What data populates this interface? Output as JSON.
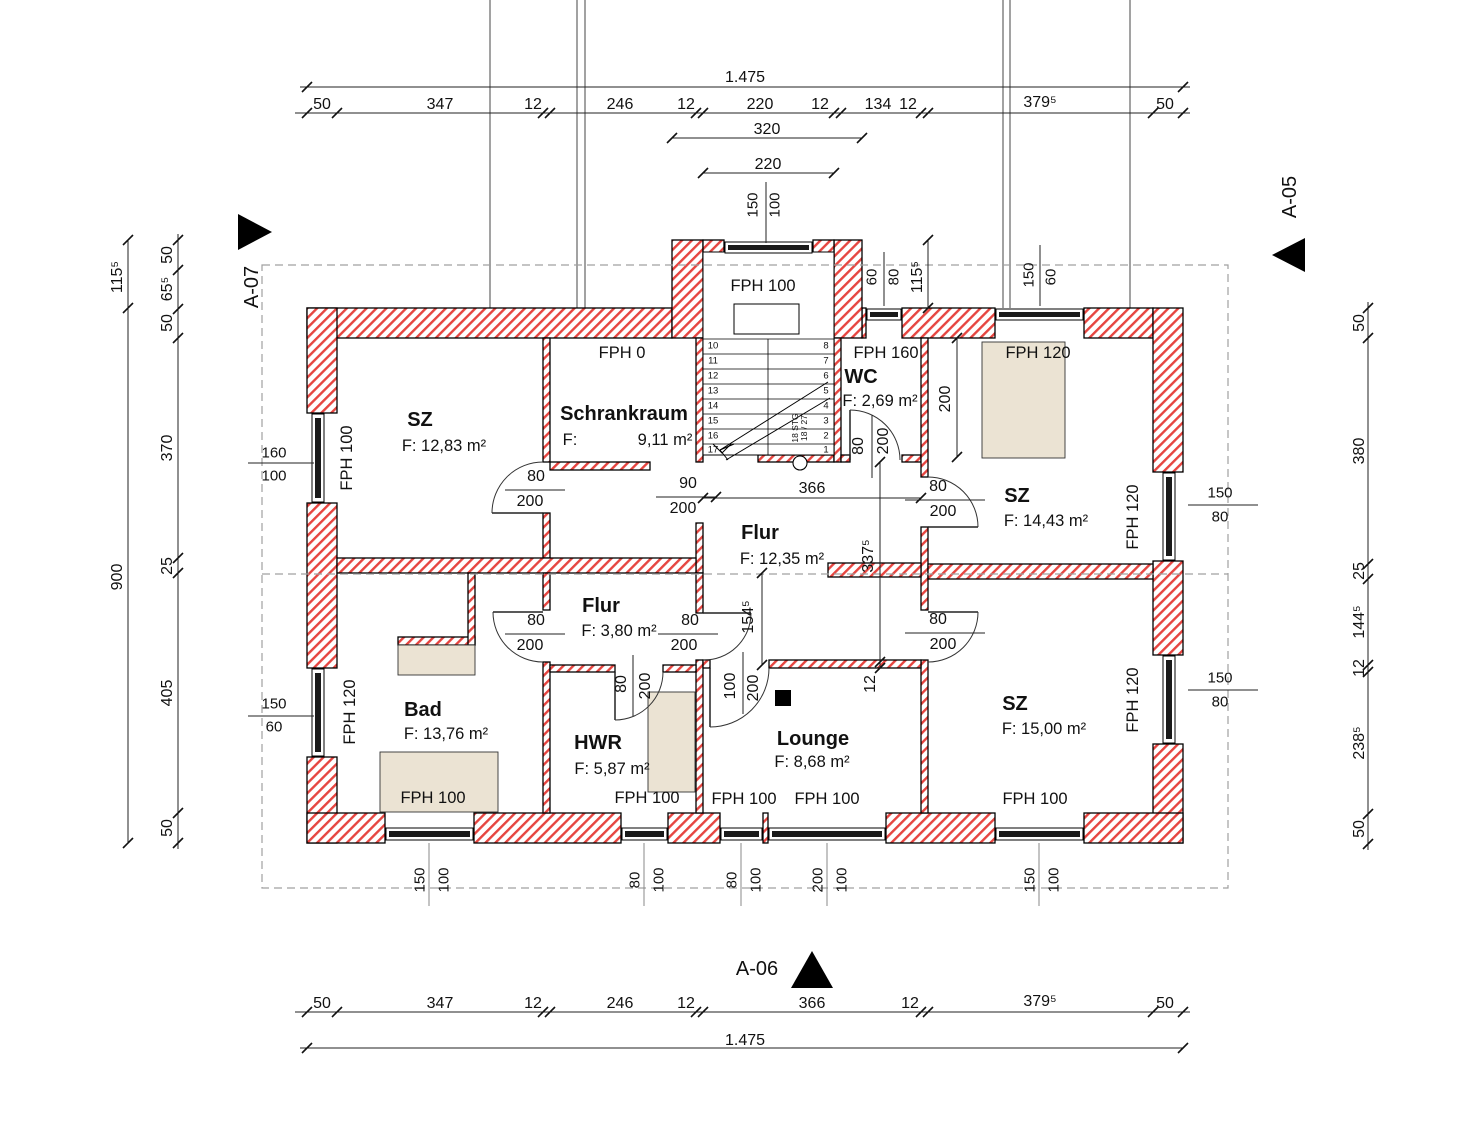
{
  "drawing": {
    "kind": "architectural floor plan",
    "total_width_label": "1.475",
    "section_markers": [
      "A-07",
      "A-05",
      "A-06"
    ],
    "rooms": [
      {
        "name": "SZ",
        "area": "F: 12,83 m²"
      },
      {
        "name": "Schrankraum",
        "area": "F: 9,11 m²"
      },
      {
        "name": "WC",
        "area": "F: 2,69 m²"
      },
      {
        "name": "SZ",
        "area": "F: 14,43 m²"
      },
      {
        "name": "Flur",
        "area": "F: 12,35 m²"
      },
      {
        "name": "Flur",
        "area": "F: 3,80 m²"
      },
      {
        "name": "Bad",
        "area": "F: 13,76 m²"
      },
      {
        "name": "HWR",
        "area": "F: 5,87 m²"
      },
      {
        "name": "Lounge",
        "area": "F: 8,68 m²"
      },
      {
        "name": "SZ",
        "area": "F: 15,00 m²"
      }
    ],
    "stair": {
      "note": "18 STG 18/27",
      "treads_left": [
        "10",
        "11",
        "12",
        "13",
        "14",
        "15",
        "16",
        "17"
      ],
      "treads_right": [
        "8",
        "7",
        "6",
        "5",
        "4",
        "3",
        "2",
        "1"
      ]
    },
    "colors": {
      "wall_hatch": "#e64540",
      "fixture": "#ebe3d3",
      "dashed": "#a0a0a0"
    }
  },
  "labels": [
    {
      "t": "1.475",
      "x": 745,
      "y": 78,
      "c": "dim"
    },
    {
      "t": "50",
      "x": 322,
      "y": 105,
      "c": "dim"
    },
    {
      "t": "347",
      "x": 440,
      "y": 105,
      "c": "dim"
    },
    {
      "t": "12",
      "x": 533,
      "y": 105,
      "c": "dim"
    },
    {
      "t": "246",
      "x": 620,
      "y": 105,
      "c": "dim"
    },
    {
      "t": "12",
      "x": 686,
      "y": 105,
      "c": "dim"
    },
    {
      "t": "220",
      "x": 760,
      "y": 105,
      "c": "dim"
    },
    {
      "t": "12",
      "x": 820,
      "y": 105,
      "c": "dim"
    },
    {
      "t": "134",
      "x": 878,
      "y": 105,
      "c": "dim"
    },
    {
      "t": "12",
      "x": 908,
      "y": 105,
      "c": "dim"
    },
    {
      "t": "379⁵",
      "x": 1040,
      "y": 103,
      "c": "dim"
    },
    {
      "t": "50",
      "x": 1165,
      "y": 105,
      "c": "dim"
    },
    {
      "t": "320",
      "x": 767,
      "y": 130,
      "c": "dim"
    },
    {
      "t": "220",
      "x": 768,
      "y": 165,
      "c": "dim"
    },
    {
      "t": "150",
      "x": 753,
      "y": 205,
      "r": -90,
      "c": "wdim"
    },
    {
      "t": "100",
      "x": 775,
      "y": 205,
      "r": -90,
      "c": "wdim"
    },
    {
      "t": "115⁵",
      "x": 118,
      "y": 277,
      "r": -90,
      "c": "dim"
    },
    {
      "t": "900",
      "x": 118,
      "y": 577,
      "r": -90,
      "c": "dim"
    },
    {
      "t": "50",
      "x": 168,
      "y": 255,
      "r": -90,
      "c": "dim"
    },
    {
      "t": "65⁵",
      "x": 168,
      "y": 289,
      "r": -90,
      "c": "dim"
    },
    {
      "t": "50",
      "x": 168,
      "y": 323,
      "r": -90,
      "c": "dim"
    },
    {
      "t": "370",
      "x": 168,
      "y": 448,
      "r": -90,
      "c": "dim"
    },
    {
      "t": "25",
      "x": 168,
      "y": 566,
      "r": -90,
      "c": "dim"
    },
    {
      "t": "405",
      "x": 168,
      "y": 693,
      "r": -90,
      "c": "dim"
    },
    {
      "t": "50",
      "x": 168,
      "y": 828,
      "r": -90,
      "c": "dim"
    },
    {
      "t": "160",
      "x": 274,
      "y": 453,
      "c": "wdim"
    },
    {
      "t": "100",
      "x": 274,
      "y": 476,
      "c": "wdim"
    },
    {
      "t": "150",
      "x": 274,
      "y": 704,
      "c": "wdim"
    },
    {
      "t": "60",
      "x": 274,
      "y": 727,
      "c": "wdim"
    },
    {
      "t": "50",
      "x": 1360,
      "y": 323,
      "r": -90,
      "c": "dim"
    },
    {
      "t": "380",
      "x": 1360,
      "y": 451,
      "r": -90,
      "c": "dim"
    },
    {
      "t": "25",
      "x": 1360,
      "y": 571,
      "r": -90,
      "c": "dim"
    },
    {
      "t": "144⁵",
      "x": 1360,
      "y": 622,
      "r": -90,
      "c": "dim"
    },
    {
      "t": "12",
      "x": 1360,
      "y": 668,
      "r": -90,
      "c": "dim"
    },
    {
      "t": "238⁵",
      "x": 1360,
      "y": 743,
      "r": -90,
      "c": "dim"
    },
    {
      "t": "50",
      "x": 1360,
      "y": 829,
      "r": -90,
      "c": "dim"
    },
    {
      "t": "150",
      "x": 1220,
      "y": 493,
      "c": "wdim"
    },
    {
      "t": "80",
      "x": 1220,
      "y": 517,
      "c": "wdim"
    },
    {
      "t": "150",
      "x": 1220,
      "y": 678,
      "c": "wdim"
    },
    {
      "t": "80",
      "x": 1220,
      "y": 702,
      "c": "wdim"
    },
    {
      "t": "60",
      "x": 872,
      "y": 277,
      "r": -90,
      "c": "wdim"
    },
    {
      "t": "80",
      "x": 894,
      "y": 277,
      "r": -90,
      "c": "wdim"
    },
    {
      "t": "115⁵",
      "x": 918,
      "y": 277,
      "r": -90,
      "c": "dim"
    },
    {
      "t": "150",
      "x": 1029,
      "y": 275,
      "r": -90,
      "c": "wdim"
    },
    {
      "t": "60",
      "x": 1051,
      "y": 277,
      "r": -90,
      "c": "wdim"
    },
    {
      "t": "150",
      "x": 420,
      "y": 880,
      "r": -90,
      "c": "wdim"
    },
    {
      "t": "100",
      "x": 444,
      "y": 880,
      "r": -90,
      "c": "wdim"
    },
    {
      "t": "80",
      "x": 635,
      "y": 880,
      "r": -90,
      "c": "wdim"
    },
    {
      "t": "100",
      "x": 659,
      "y": 880,
      "r": -90,
      "c": "wdim"
    },
    {
      "t": "80",
      "x": 732,
      "y": 880,
      "r": -90,
      "c": "wdim"
    },
    {
      "t": "100",
      "x": 756,
      "y": 880,
      "r": -90,
      "c": "wdim"
    },
    {
      "t": "200",
      "x": 818,
      "y": 880,
      "r": -90,
      "c": "wdim"
    },
    {
      "t": "100",
      "x": 842,
      "y": 880,
      "r": -90,
      "c": "wdim"
    },
    {
      "t": "150",
      "x": 1030,
      "y": 880,
      "r": -90,
      "c": "wdim"
    },
    {
      "t": "100",
      "x": 1054,
      "y": 880,
      "r": -90,
      "c": "wdim"
    },
    {
      "t": "50",
      "x": 322,
      "y": 1004,
      "c": "dim"
    },
    {
      "t": "347",
      "x": 440,
      "y": 1004,
      "c": "dim"
    },
    {
      "t": "12",
      "x": 533,
      "y": 1004,
      "c": "dim"
    },
    {
      "t": "246",
      "x": 620,
      "y": 1004,
      "c": "dim"
    },
    {
      "t": "12",
      "x": 686,
      "y": 1004,
      "c": "dim"
    },
    {
      "t": "366",
      "x": 812,
      "y": 1004,
      "c": "dim"
    },
    {
      "t": "12",
      "x": 910,
      "y": 1004,
      "c": "dim"
    },
    {
      "t": "379⁵",
      "x": 1040,
      "y": 1002,
      "c": "dim"
    },
    {
      "t": "50",
      "x": 1165,
      "y": 1004,
      "c": "dim"
    },
    {
      "t": "1.475",
      "x": 745,
      "y": 1041,
      "c": "dim"
    },
    {
      "t": "90",
      "x": 688,
      "y": 484,
      "c": "dim"
    },
    {
      "t": "200",
      "x": 683,
      "y": 509,
      "c": "dim"
    },
    {
      "t": "366",
      "x": 812,
      "y": 489,
      "c": "dim"
    },
    {
      "t": "337⁵",
      "x": 869,
      "y": 556,
      "r": -90,
      "c": "dim"
    },
    {
      "t": "154⁵",
      "x": 749,
      "y": 617,
      "r": -90,
      "c": "dim"
    },
    {
      "t": "12",
      "x": 871,
      "y": 684,
      "r": -90,
      "c": "dim"
    },
    {
      "t": "80",
      "x": 536,
      "y": 477,
      "c": "dim"
    },
    {
      "t": "200",
      "x": 530,
      "y": 502,
      "c": "dim"
    },
    {
      "t": "80",
      "x": 536,
      "y": 621,
      "c": "dim"
    },
    {
      "t": "200",
      "x": 530,
      "y": 646,
      "c": "dim"
    },
    {
      "t": "80",
      "x": 690,
      "y": 621,
      "c": "dim"
    },
    {
      "t": "200",
      "x": 684,
      "y": 646,
      "c": "dim"
    },
    {
      "t": "80",
      "x": 938,
      "y": 487,
      "c": "dim"
    },
    {
      "t": "200",
      "x": 943,
      "y": 512,
      "c": "dim"
    },
    {
      "t": "80",
      "x": 938,
      "y": 620,
      "c": "dim"
    },
    {
      "t": "200",
      "x": 943,
      "y": 645,
      "c": "dim"
    },
    {
      "t": "80",
      "x": 622,
      "y": 684,
      "r": -90,
      "c": "dim"
    },
    {
      "t": "200",
      "x": 646,
      "y": 686,
      "r": -90,
      "c": "dim"
    },
    {
      "t": "100",
      "x": 731,
      "y": 686,
      "r": -90,
      "c": "dim"
    },
    {
      "t": "200",
      "x": 754,
      "y": 688,
      "r": -90,
      "c": "dim"
    },
    {
      "t": "80",
      "x": 859,
      "y": 446,
      "r": -90,
      "c": "dim"
    },
    {
      "t": "200",
      "x": 884,
      "y": 441,
      "r": -90,
      "c": "dim"
    },
    {
      "t": "200",
      "x": 946,
      "y": 399,
      "r": -90,
      "c": "dim"
    },
    {
      "t": "FPH 100",
      "x": 763,
      "y": 286,
      "c": "fph"
    },
    {
      "t": "FPH 0",
      "x": 622,
      "y": 353,
      "c": "fph"
    },
    {
      "t": "FPH 160",
      "x": 886,
      "y": 353,
      "c": "fph"
    },
    {
      "t": "FPH 120",
      "x": 1038,
      "y": 353,
      "c": "fph"
    },
    {
      "t": "FPH 100",
      "x": 347,
      "y": 458,
      "r": -90,
      "c": "fph"
    },
    {
      "t": "FPH 120",
      "x": 1133,
      "y": 517,
      "r": -90,
      "c": "fph"
    },
    {
      "t": "FPH 120",
      "x": 350,
      "y": 712,
      "r": -90,
      "c": "fph"
    },
    {
      "t": "FPH 120",
      "x": 1133,
      "y": 700,
      "r": -90,
      "c": "fph"
    },
    {
      "t": "FPH 100",
      "x": 433,
      "y": 798,
      "c": "fph"
    },
    {
      "t": "FPH 100",
      "x": 647,
      "y": 798,
      "c": "fph"
    },
    {
      "t": "FPH 100",
      "x": 744,
      "y": 799,
      "c": "fph"
    },
    {
      "t": "FPH 100",
      "x": 827,
      "y": 799,
      "c": "fph"
    },
    {
      "t": "FPH 100",
      "x": 1035,
      "y": 799,
      "c": "fph"
    },
    {
      "t": "SZ",
      "x": 420,
      "y": 420,
      "c": "room"
    },
    {
      "t": "F: 12,83 m²",
      "x": 444,
      "y": 446,
      "c": "area"
    },
    {
      "t": "Schrankraum",
      "x": 624,
      "y": 414,
      "c": "room"
    },
    {
      "t": "F:",
      "x": 570,
      "y": 440,
      "c": "area"
    },
    {
      "t": "9,11 m²",
      "x": 665,
      "y": 440,
      "c": "area"
    },
    {
      "t": "WC",
      "x": 861,
      "y": 377,
      "c": "room"
    },
    {
      "t": "F: 2,69 m²",
      "x": 880,
      "y": 401,
      "c": "area"
    },
    {
      "t": "SZ",
      "x": 1017,
      "y": 496,
      "c": "room"
    },
    {
      "t": "F: 14,43 m²",
      "x": 1046,
      "y": 521,
      "c": "area"
    },
    {
      "t": "Flur",
      "x": 760,
      "y": 533,
      "c": "room"
    },
    {
      "t": "F: 12,35 m²",
      "x": 782,
      "y": 559,
      "c": "area"
    },
    {
      "t": "Flur",
      "x": 601,
      "y": 606,
      "c": "room"
    },
    {
      "t": "F: 3,80 m²",
      "x": 619,
      "y": 631,
      "c": "area"
    },
    {
      "t": "Bad",
      "x": 423,
      "y": 710,
      "c": "room"
    },
    {
      "t": "F: 13,76 m²",
      "x": 446,
      "y": 734,
      "c": "area"
    },
    {
      "t": "HWR",
      "x": 598,
      "y": 743,
      "c": "room"
    },
    {
      "t": "F: 5,87 m²",
      "x": 612,
      "y": 769,
      "c": "area"
    },
    {
      "t": "Lounge",
      "x": 813,
      "y": 739,
      "c": "room"
    },
    {
      "t": "F: 8,68 m²",
      "x": 812,
      "y": 762,
      "c": "area"
    },
    {
      "t": "SZ",
      "x": 1015,
      "y": 704,
      "c": "room"
    },
    {
      "t": "F: 15,00 m²",
      "x": 1044,
      "y": 729,
      "c": "area"
    },
    {
      "t": "A-07",
      "x": 252,
      "y": 287,
      "r": -90,
      "c": "marker"
    },
    {
      "t": "A-05",
      "x": 1290,
      "y": 197,
      "r": -90,
      "c": "marker"
    },
    {
      "t": "A-06",
      "x": 757,
      "y": 969,
      "c": "marker"
    },
    {
      "t": "10",
      "x": 713,
      "y": 346,
      "c": "snum"
    },
    {
      "t": "11",
      "x": 713,
      "y": 361,
      "c": "snum"
    },
    {
      "t": "12",
      "x": 713,
      "y": 376,
      "c": "snum"
    },
    {
      "t": "13",
      "x": 713,
      "y": 391,
      "c": "snum"
    },
    {
      "t": "14",
      "x": 713,
      "y": 406,
      "c": "snum"
    },
    {
      "t": "15",
      "x": 713,
      "y": 421,
      "c": "snum"
    },
    {
      "t": "16",
      "x": 713,
      "y": 436,
      "c": "snum"
    },
    {
      "t": "17",
      "x": 713,
      "y": 450,
      "c": "snum"
    },
    {
      "t": "8",
      "x": 826,
      "y": 346,
      "c": "snum"
    },
    {
      "t": "7",
      "x": 826,
      "y": 361,
      "c": "snum"
    },
    {
      "t": "6",
      "x": 826,
      "y": 376,
      "c": "snum"
    },
    {
      "t": "5",
      "x": 826,
      "y": 391,
      "c": "snum"
    },
    {
      "t": "4",
      "x": 826,
      "y": 406,
      "c": "snum"
    },
    {
      "t": "3",
      "x": 826,
      "y": 421,
      "c": "snum"
    },
    {
      "t": "2",
      "x": 826,
      "y": 436,
      "c": "snum"
    },
    {
      "t": "1",
      "x": 826,
      "y": 450,
      "c": "snum"
    },
    {
      "t": "18 STG",
      "x": 795,
      "y": 428,
      "r": -90,
      "c": "snote"
    },
    {
      "t": "18 / 27",
      "x": 804,
      "y": 428,
      "r": -90,
      "c": "snote"
    }
  ]
}
